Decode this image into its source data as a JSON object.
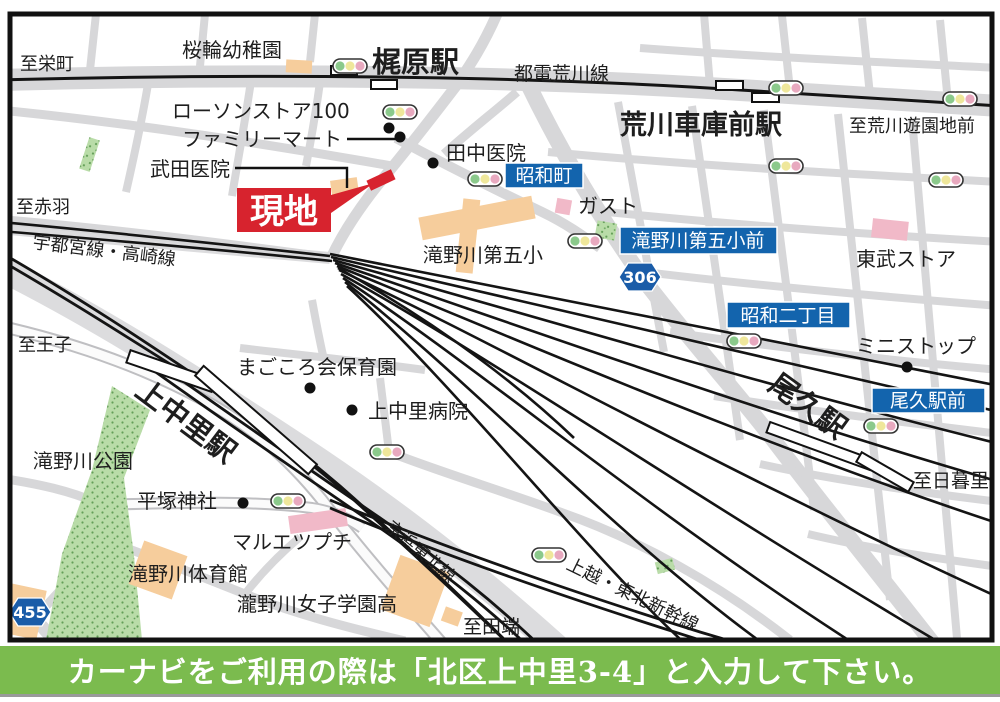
{
  "banner": {
    "text": "カーナビをご利用の際は「北区上中里3-4」と入力して下さい。"
  },
  "site_marker": {
    "label": "現地"
  },
  "stations": {
    "kajiwara": "梶原駅",
    "arakawa_shako_mae": "荒川車庫前駅",
    "oku": "尾久駅",
    "kaminakazato": "上中里駅"
  },
  "rail_lines": {
    "toden_arakawa": "都電荒川線",
    "utsunomiya_takasaki": "宇都宮線・高崎線",
    "keihin_tohoku": "京浜東北線",
    "joetsu_tohoku_shinkansen": "上越・東北新幹線"
  },
  "directions": {
    "sakaecho": "至栄町",
    "akabane": "至赤羽",
    "arakawa_yuenchi_mae": "至荒川遊園地前",
    "oji": "至王子",
    "nippori": "至日暮里",
    "tabata": "至田端"
  },
  "bus_stops": {
    "showacho": "昭和町",
    "takinogawa_daigo_sho_mae": "滝野川第五小前",
    "showa_nichome": "昭和二丁目",
    "oku_ekimae": "尾久駅前"
  },
  "route_shields": {
    "r306": "306",
    "r455": "455"
  },
  "pois": {
    "sakurawa_kindergarten": "桜輪幼稚園",
    "lawson_store_100": "ローソンストア100",
    "familymart": "ファミリーマート",
    "takeda_clinic": "武田医院",
    "tanaka_clinic": "田中医院",
    "gusto": "ガスト",
    "takinogawa_daigo_elementary": "滝野川第五小",
    "tobu_store": "東武ストア",
    "ministop": "ミニストップ",
    "magokoro_nursery": "まごころ会保育園",
    "kaminakazato_hospital": "上中里病院",
    "takinogawa_park": "滝野川公園",
    "hiratsuka_shrine": "平塚神社",
    "maruetsu_petit": "マルエツプチ",
    "takinogawa_gym": "滝野川体育館",
    "takinogawa_girls_school": "瀧野川女子学園高"
  },
  "colors": {
    "bus_stop_bg": "#1364AD",
    "shield_bg": "#1A5CA8",
    "site_red": "#D7232E",
    "banner_green": "#7BBB4E",
    "road_gray": "#D7D7D9",
    "corridor_gray": "#DCDCDE",
    "park_green": "#B9DCA8",
    "building_peach": "#F6CD9C",
    "building_pink": "#F1B9C8",
    "rail_black": "#141414",
    "signal_green": "#8BC98B",
    "signal_yellow": "#EFE79B",
    "signal_pink": "#E8A9BF"
  }
}
